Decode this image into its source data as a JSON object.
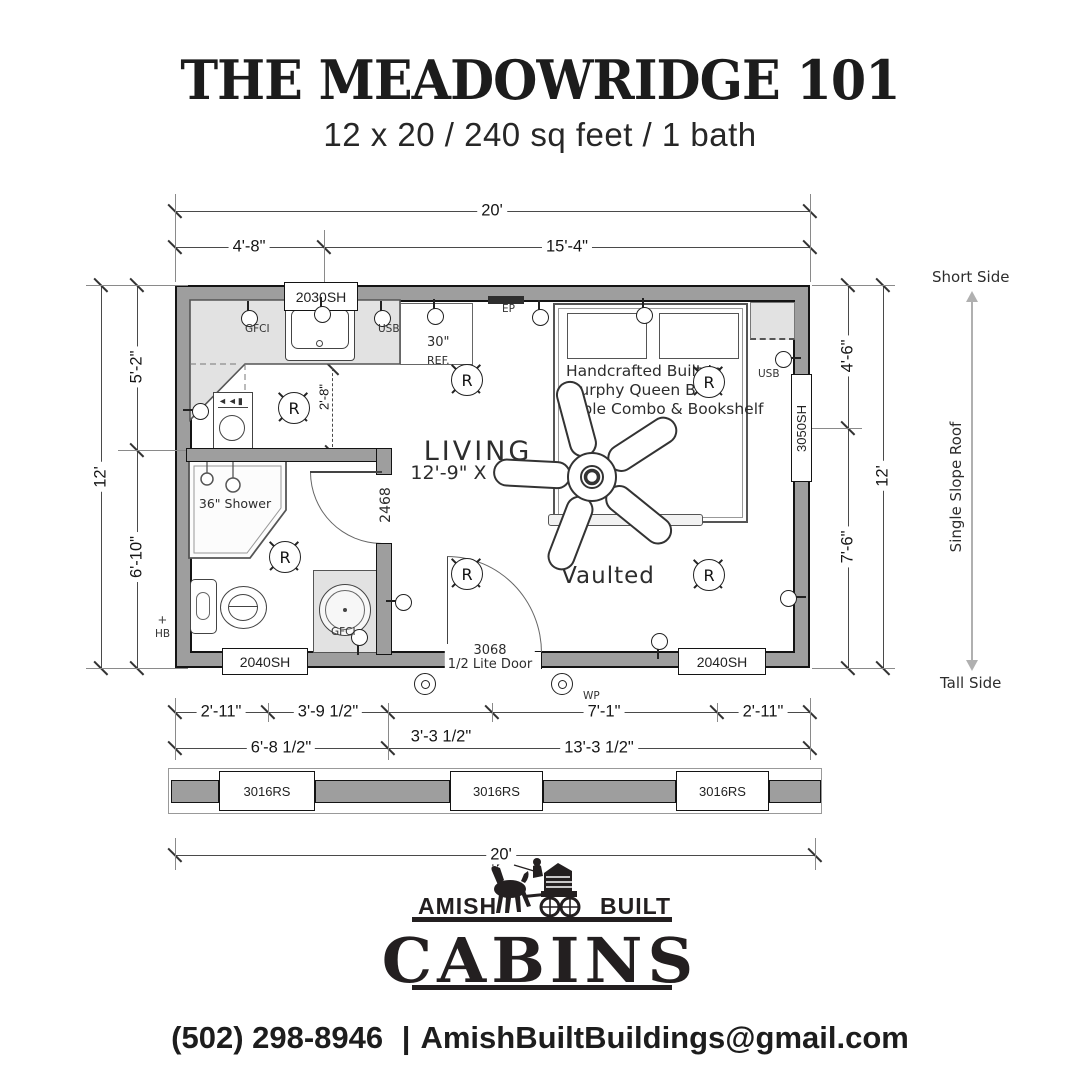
{
  "header": {
    "title": "THE MEADOWRIDGE 101",
    "subtitle": "12 x 20 / 240 sq feet / 1 bath"
  },
  "plan": {
    "windows": {
      "top": "2030SH",
      "right": "3050SH",
      "bottom_left": "2040SH",
      "bottom_right": "2040SH",
      "transom_1": "3016RS",
      "transom_2": "3016RS",
      "transom_3": "3016RS"
    },
    "doors": {
      "entry_size": "3068",
      "entry_type": "1/2 Lite Door",
      "bath": "2468"
    },
    "rooms": {
      "living": "LIVING",
      "living_size": "12'-9\" X 11'-0\"",
      "vaulted": "Vaulted",
      "shower": "36\" Shower",
      "bed1": "Handcrafted Built-In",
      "bed2": "Murphy Queen Bed",
      "bed3": "Table Combo & Bookshelf",
      "ref_size": "30\"",
      "ref": "REF."
    },
    "dims": {
      "top_total": "20'",
      "top_left": "4'-8\"",
      "top_right": "15'-4\"",
      "left_total": "12'",
      "left_upper": "5'-2\"",
      "left_lower": "6'-10\"",
      "right_upper": "4'-6\"",
      "right_lower": "7'-6\"",
      "right_total": "12'",
      "kitchen": "2'-8\"",
      "b1": "2'-11\"",
      "b2": "3'-9 1/2\"",
      "b3": "3'-3 1/2\"",
      "b4": "7'-1\"",
      "b5": "2'-11\"",
      "b6": "6'-8 1/2\"",
      "b7": "13'-3 1/2\"",
      "bottom_total": "20'"
    },
    "annotations": {
      "short_side": "Short Side",
      "roof": "Single Slope Roof",
      "tall_side": "Tall Side",
      "ep": "EP",
      "hb": "HB",
      "wp": "WP",
      "gfci_kitchen": "GFCI",
      "usb_kitchen": "USB",
      "usb_wall": "USB",
      "gfci_bath": "GFCI"
    },
    "electrical": {
      "outlets": [
        {
          "x": 248,
          "y": 317,
          "dir": "up"
        },
        {
          "x": 321,
          "y": 313,
          "dir": "up"
        },
        {
          "x": 381,
          "y": 317,
          "dir": "up"
        },
        {
          "x": 434,
          "y": 315,
          "dir": "up"
        },
        {
          "x": 539,
          "y": 316,
          "dir": "up"
        },
        {
          "x": 643,
          "y": 314,
          "dir": "up"
        },
        {
          "x": 199,
          "y": 410,
          "dir": "left"
        },
        {
          "x": 782,
          "y": 358,
          "dir": "right"
        },
        {
          "x": 787,
          "y": 597,
          "dir": "right"
        },
        {
          "x": 658,
          "y": 640,
          "dir": "down"
        },
        {
          "x": 402,
          "y": 601,
          "dir": "left"
        },
        {
          "x": 358,
          "y": 636,
          "dir": "down"
        }
      ],
      "exterior_outlets": [
        {
          "x": 424,
          "y": 683
        },
        {
          "x": 561,
          "y": 683
        }
      ],
      "recessed_lights": [
        {
          "x": 293,
          "y": 407
        },
        {
          "x": 466,
          "y": 379
        },
        {
          "x": 708,
          "y": 381
        },
        {
          "x": 284,
          "y": 556
        },
        {
          "x": 466,
          "y": 573
        },
        {
          "x": 708,
          "y": 574
        }
      ]
    }
  },
  "logo": {
    "amish": "AMISH",
    "built": "BUILT",
    "cabins": "CABINS"
  },
  "contact": {
    "phone": "(502) 298-8946",
    "separator": "|",
    "email": "AmishBuiltBuildings@gmail.com"
  }
}
